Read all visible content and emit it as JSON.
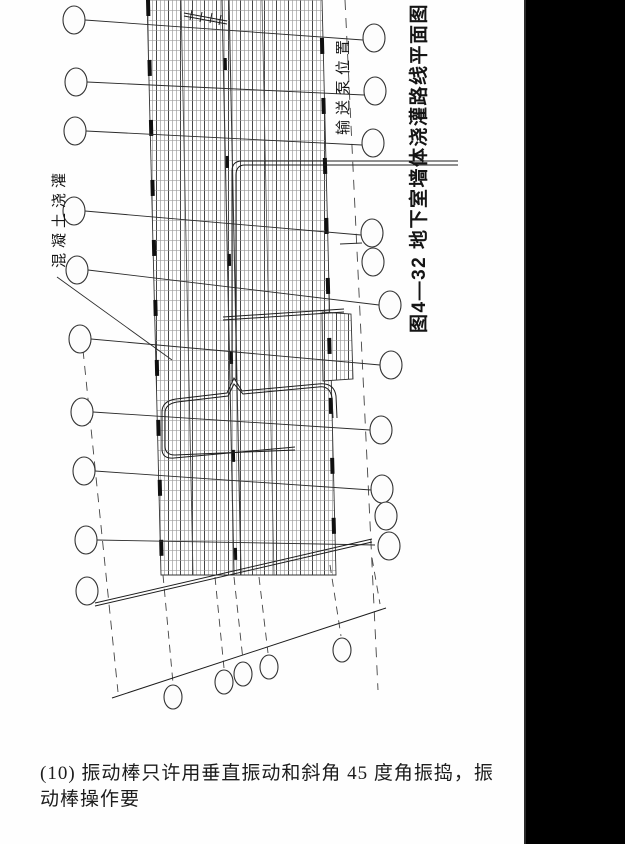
{
  "page": {
    "background": "#fefefe",
    "scan_bar_color": "#000000",
    "line_color": "#222222"
  },
  "figure": {
    "number": "图4—32",
    "title": "地下室墙体浇灌路线平面图",
    "full_title": "图4—32 地下室墙体浇灌路线平面图",
    "labels": {
      "pump_position": "输送泵位置",
      "concrete_pour": "混凝土浇灌"
    }
  },
  "caption": {
    "text": "(10) 振动棒只许用垂直振动和斜角 45 度角振捣，振动棒操作要"
  }
}
